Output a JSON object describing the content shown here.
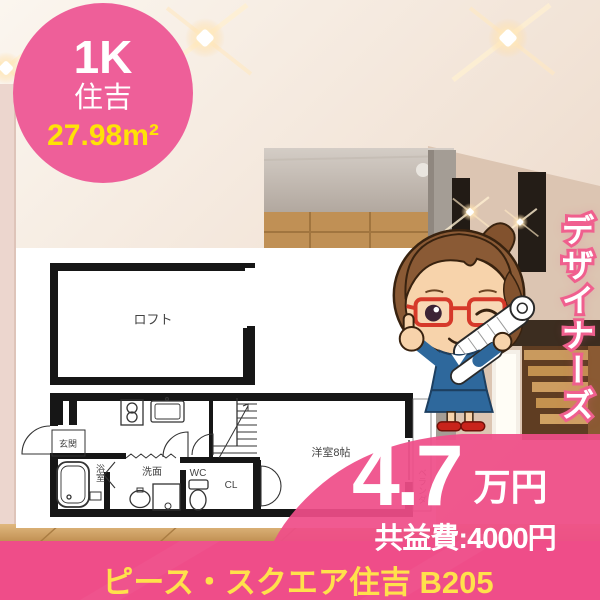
{
  "badge": {
    "layout": "1K",
    "location": "住吉",
    "area": "27.98m²"
  },
  "banner": {
    "text": "デザイナーズ"
  },
  "floorplan": {
    "loft": "ロフト",
    "entrance": "玄関",
    "bath": "浴室",
    "washstand": "洗面",
    "toilet": "WC",
    "closet": "CL",
    "main_room": "洋室8帖",
    "balcony": "ベランダ"
  },
  "price": {
    "rent": "4.7",
    "unit": "万円",
    "common_fee": "共益費:4000円"
  },
  "footer": {
    "property_name": "ピース・スクエア住吉 B205"
  },
  "colors": {
    "badge_pink": "#ee5f99",
    "primary_pink": "#ef4d89",
    "accent_yellow": "#ffe206",
    "footer_yellow": "#ffe14b"
  }
}
